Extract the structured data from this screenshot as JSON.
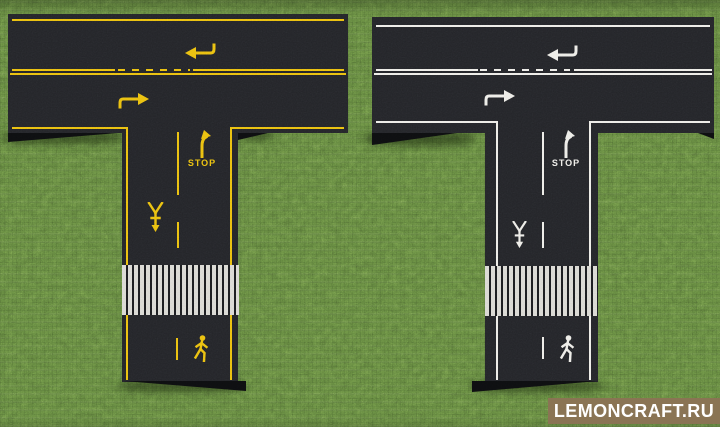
{
  "colors": {
    "grass": "#5a7939",
    "asphalt": "#232428",
    "bevel": "#0d0e10",
    "left_markings": "#e9bb10",
    "right_markings": "#ecebe6",
    "crosswalk": "#d7d6d0",
    "watermark_bg": "#8a7454",
    "watermark_text": "#ffffff"
  },
  "roads": {
    "left": {
      "marking_style": "yellow",
      "stop_label": "STOP",
      "markings": [
        "edge-lines",
        "center-line-with-passing-dashes",
        "lane-arrows",
        "turn-right-arrow",
        "stop-text",
        "yield-arrow",
        "lane-dashes",
        "crosswalk",
        "pedestrian-symbol"
      ]
    },
    "right": {
      "marking_style": "white",
      "stop_label": "STOP",
      "markings": [
        "edge-lines",
        "center-line-with-passing-dashes",
        "lane-arrows",
        "turn-right-arrow",
        "stop-text",
        "yield-arrow",
        "lane-dashes",
        "crosswalk",
        "pedestrian-symbol"
      ]
    }
  },
  "watermark": {
    "label": "LEMONCRAFT.RU"
  }
}
